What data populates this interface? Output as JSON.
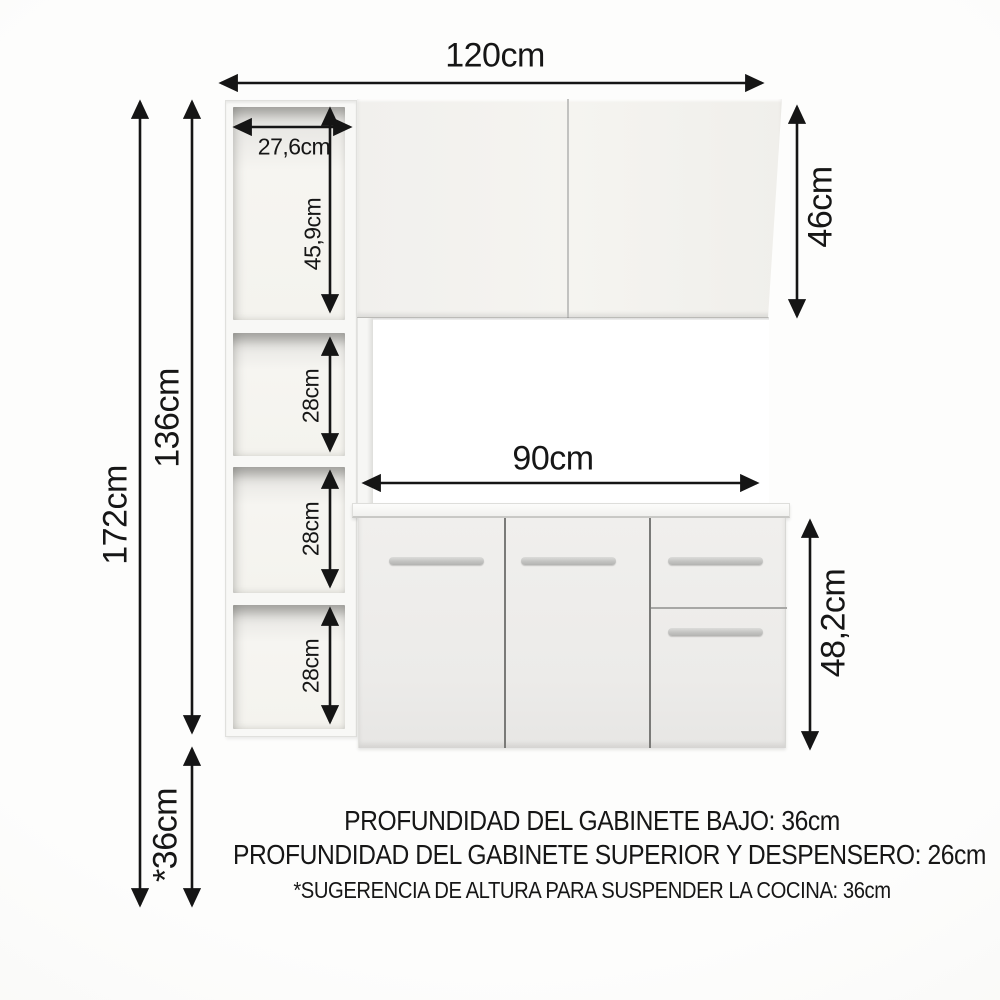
{
  "diagram": {
    "dims": {
      "width_total": "120cm",
      "pantry_width": "27,6cm",
      "pantry_top": "45,9cm",
      "pantry_sections": [
        "28cm",
        "28cm",
        "28cm"
      ],
      "height_unit": "136cm",
      "height_total": "172cm",
      "height_upper": "46cm",
      "width_base": "90cm",
      "height_base": "48,2cm",
      "height_suspend": "*36cm"
    },
    "notes": {
      "line1": "PROFUNDIDAD DEL GABINETE BAJO: 36cm",
      "line2": "PROFUNDIDAD DEL GABINETE SUPERIOR Y DESPENSERO: 26cm",
      "line3": "*SUGERENCIA DE ALTURA PARA SUSPENDER LA COCINA: 36cm"
    },
    "colors": {
      "arrow": "#151515",
      "cabinet_face": "#f2f1ee",
      "handle": "#c3c3c1"
    }
  }
}
